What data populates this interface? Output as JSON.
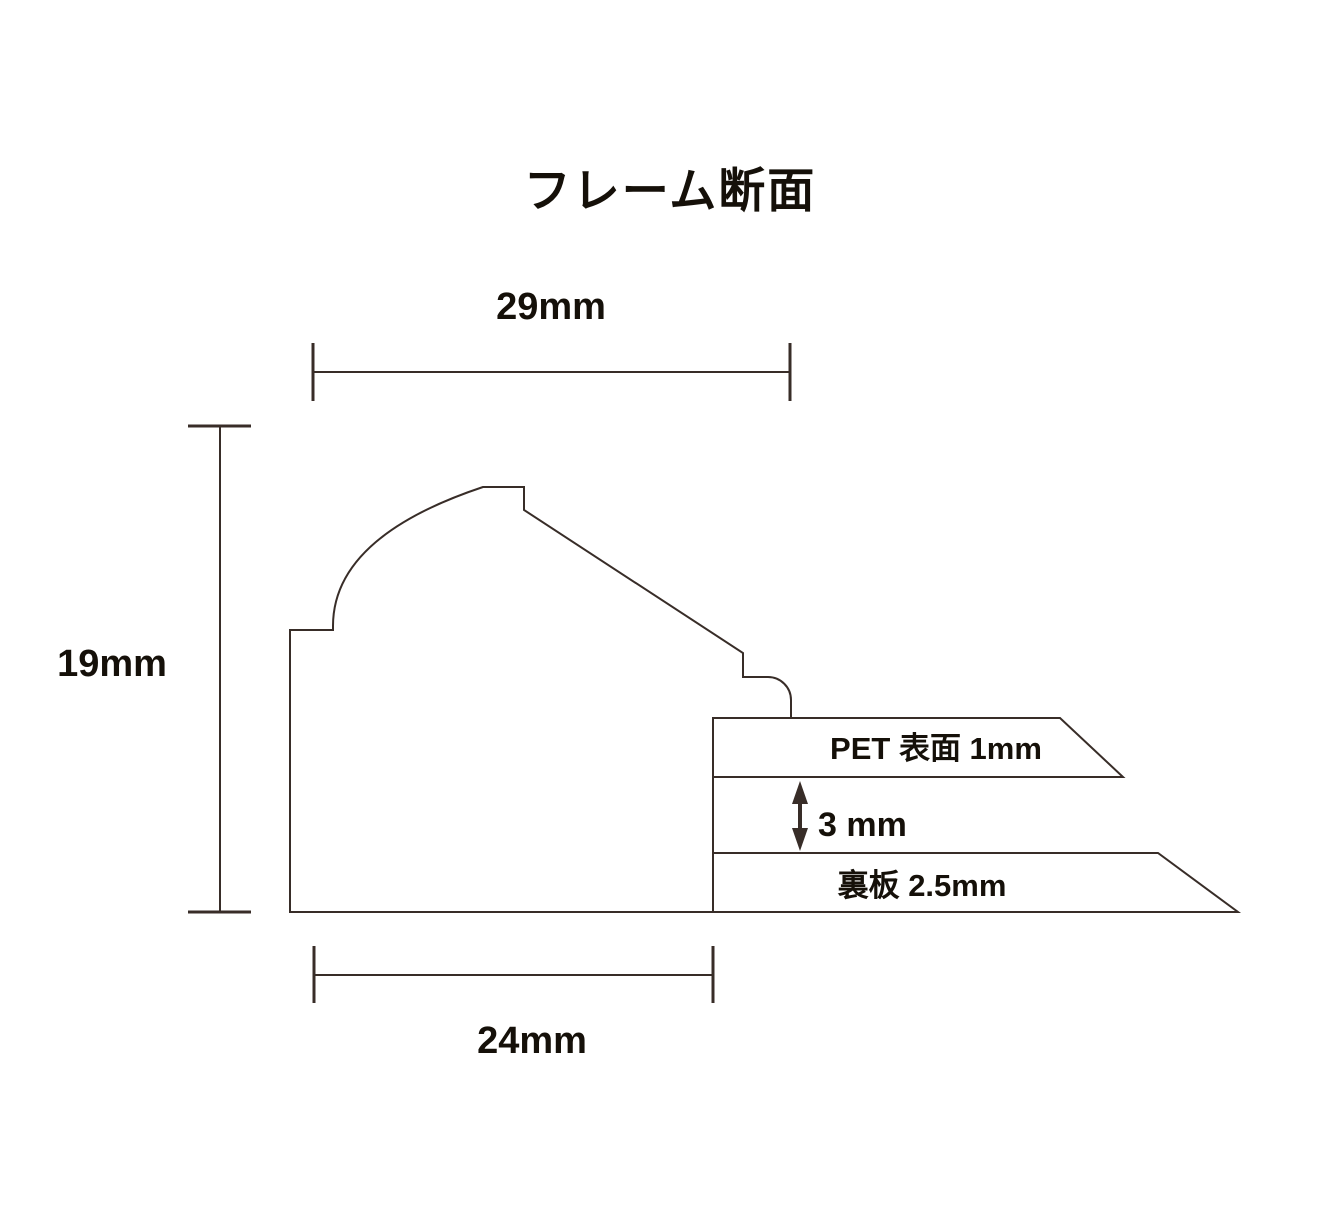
{
  "title": "フレーム断面",
  "colors": {
    "background": "#ffffff",
    "line": "#382d28",
    "text": "#151009"
  },
  "dimensions": {
    "top_width": {
      "label": "29mm",
      "orientation": "horizontal"
    },
    "left_height": {
      "label": "19mm",
      "orientation": "vertical"
    },
    "bottom_width": {
      "label": "24mm",
      "orientation": "horizontal"
    },
    "gap": {
      "label": "3 mm",
      "orientation": "vertical"
    }
  },
  "layers": {
    "pet_sheet": {
      "label": "PET 表面 1mm"
    },
    "back_board": {
      "label": "裏板 2.5mm"
    }
  }
}
